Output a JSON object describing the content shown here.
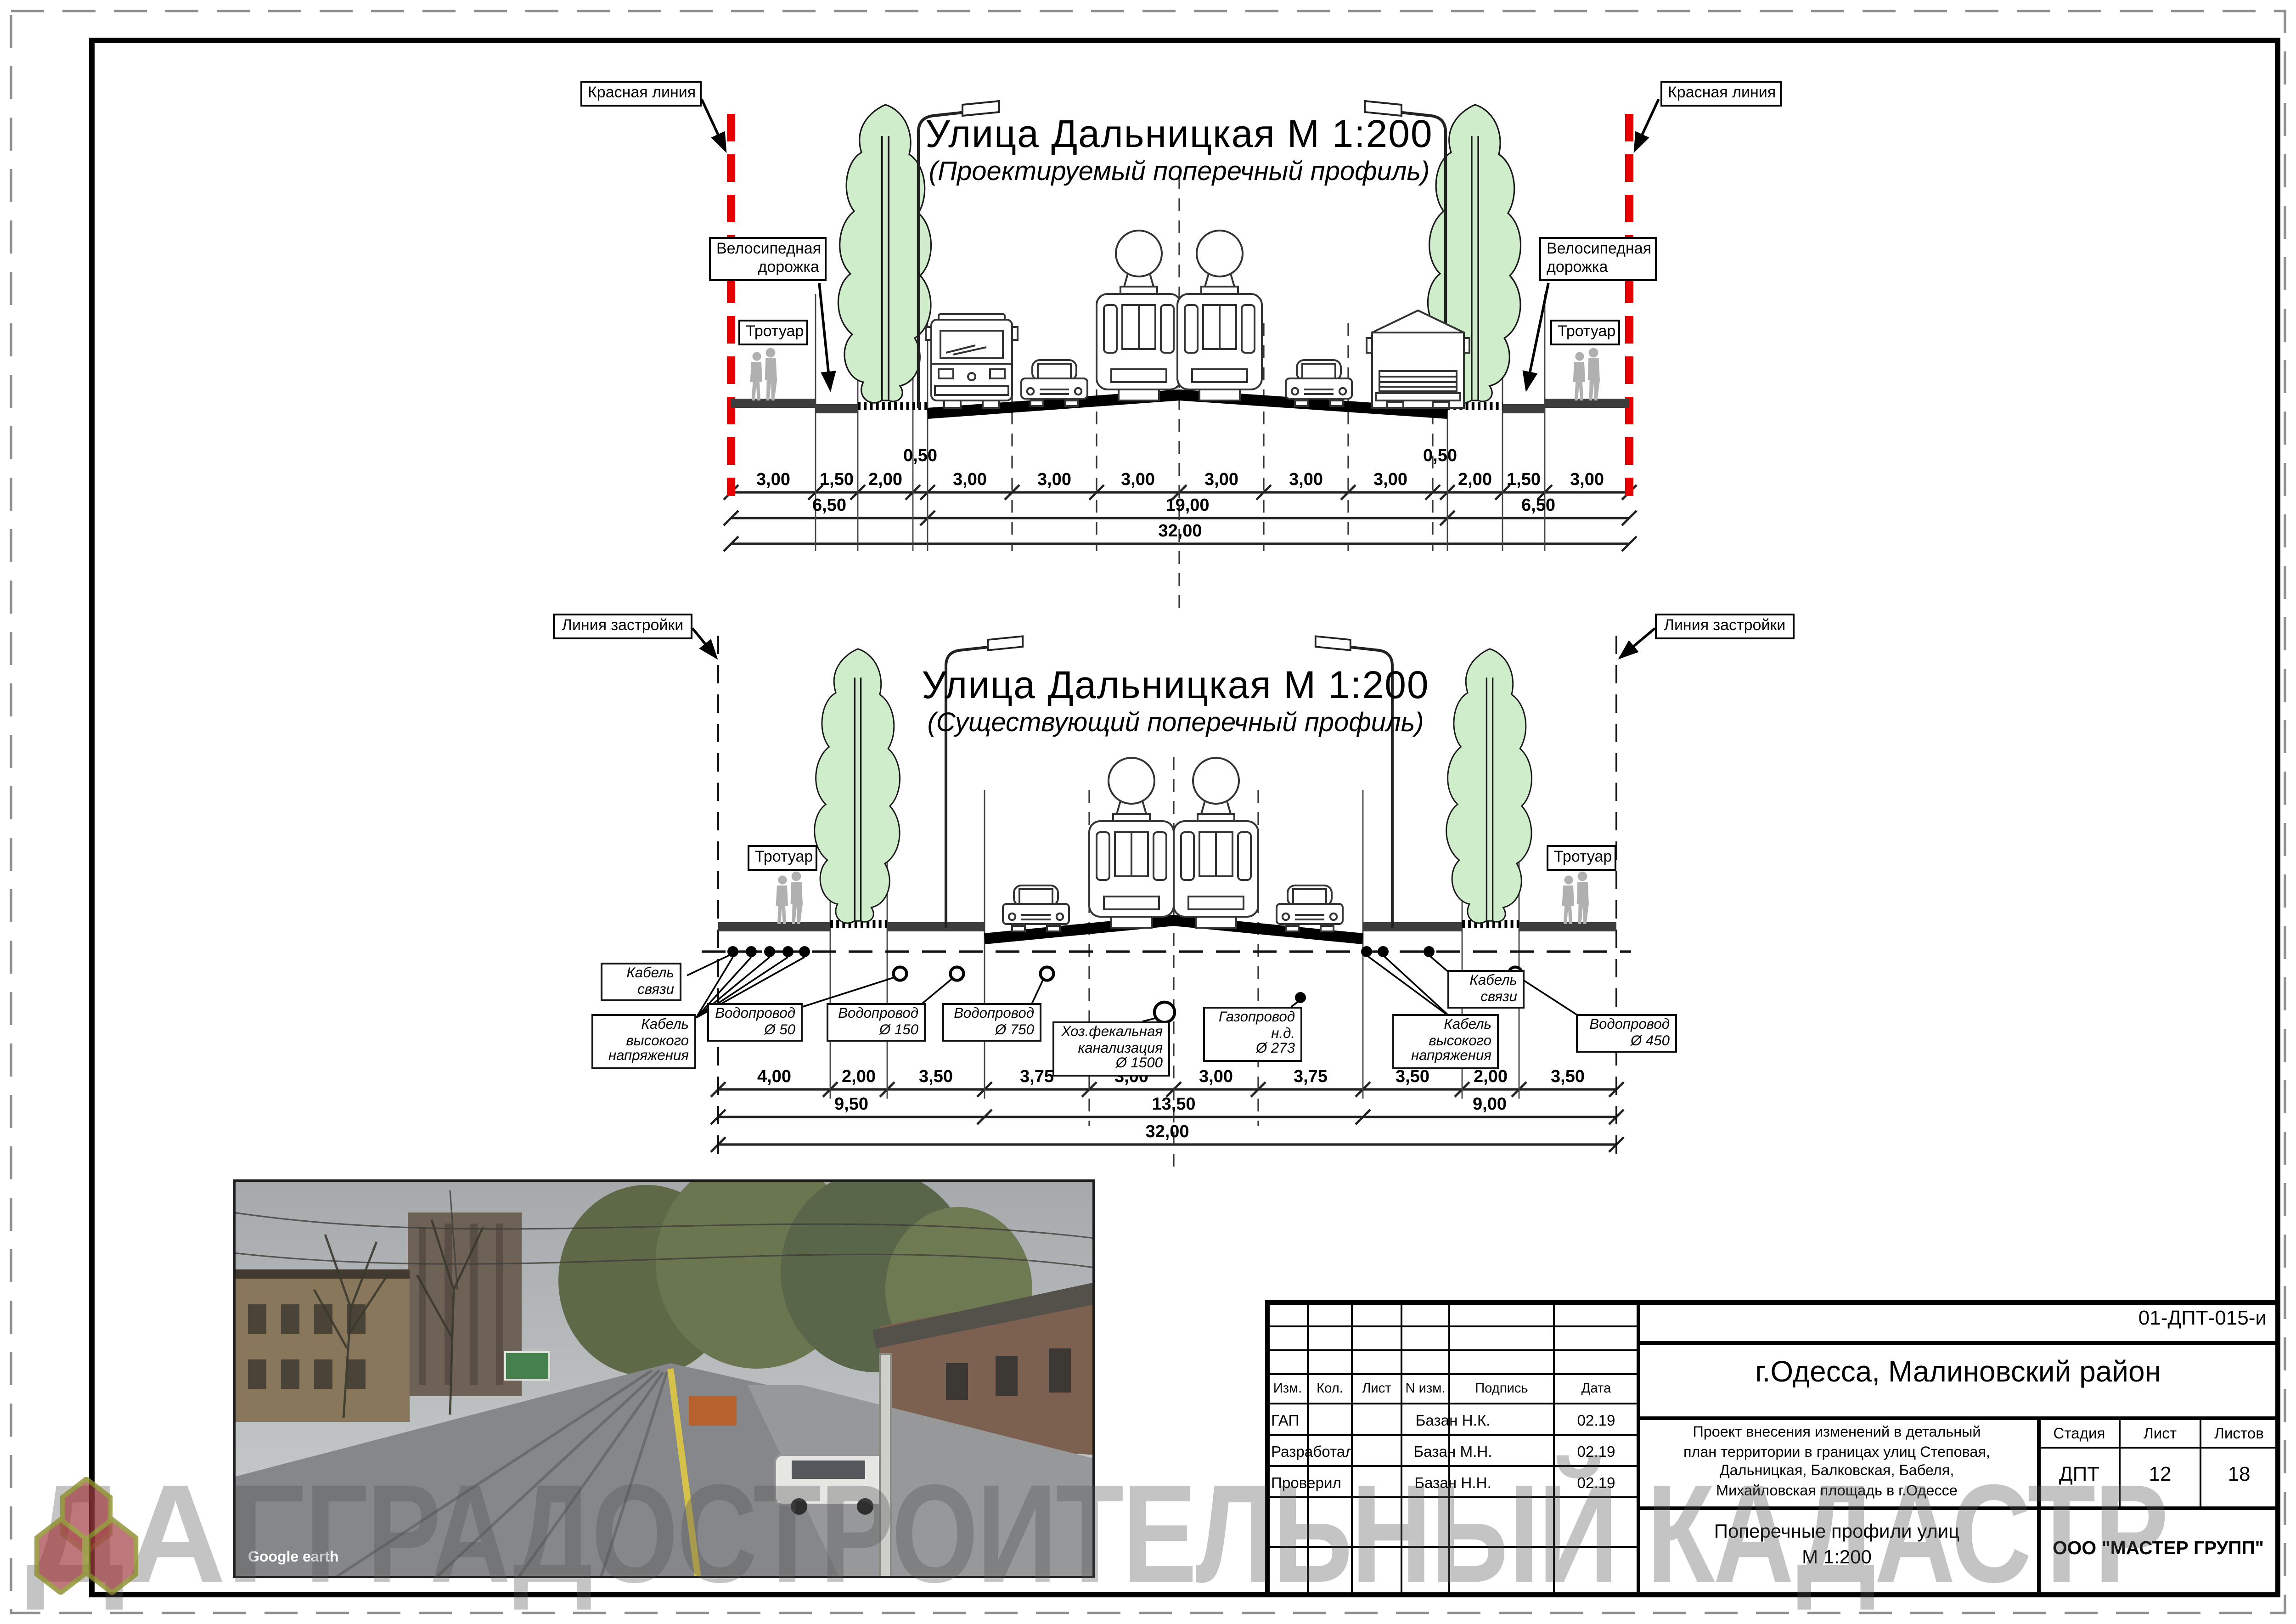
{
  "colors": {
    "red_line": "#e60000",
    "tree_green": "#cfeccb",
    "sidewalk_gray": "#3d3d3d",
    "watermark_gray": "#bdbdbd",
    "logo_red": "#9e3438",
    "logo_olive": "#8f8f2e"
  },
  "top_profile": {
    "title": "Улица Дальницкая М 1:200",
    "subtitle": "(Проектируемый поперечный профиль)",
    "red_line_label": "Красная линия",
    "bike_label_line1": "Велосипедная",
    "bike_label_line2": "дорожка",
    "sidewalk_label": "Тротуар",
    "dims_row1": [
      "3,00",
      "1,50",
      "2,00",
      "0,50",
      "3,00",
      "3,00",
      "3,00",
      "3,00",
      "3,00",
      "3,00",
      "0,50",
      "2,00",
      "1,50",
      "3,00"
    ],
    "dims_row2": [
      "6,50",
      "19,00",
      "6,50"
    ],
    "dims_row3": [
      "32,00"
    ]
  },
  "bottom_profile": {
    "title": "Улица Дальницкая М 1:200",
    "subtitle": "(Существующий поперечный профиль)",
    "building_line_label": "Линия застройки",
    "sidewalk_label": "Тротуар",
    "utilities": [
      {
        "id": "cable-comm-left",
        "lines": [
          "Кабель",
          "связи"
        ]
      },
      {
        "id": "cable-hv-left",
        "lines": [
          "Кабель",
          "высокого",
          "напряжения"
        ]
      },
      {
        "id": "water-50",
        "lines": [
          "Водопровод",
          "Ø 50"
        ]
      },
      {
        "id": "water-150",
        "lines": [
          "Водопровод",
          "Ø 150"
        ]
      },
      {
        "id": "water-750",
        "lines": [
          "Водопровод",
          "Ø 750"
        ]
      },
      {
        "id": "sewer-1500",
        "lines": [
          "Хоз.фекальная",
          "канализация",
          "Ø 1500"
        ]
      },
      {
        "id": "gas-273",
        "lines": [
          "Газопровод",
          "н.д.",
          "Ø 273"
        ]
      },
      {
        "id": "cable-hv-right",
        "lines": [
          "Кабель",
          "высокого",
          "напряжения"
        ]
      },
      {
        "id": "cable-comm-right",
        "lines": [
          "Кабель",
          "связи"
        ]
      },
      {
        "id": "water-450",
        "lines": [
          "Водопровод",
          "Ø 450"
        ]
      }
    ],
    "dims_row1": [
      "4,00",
      "2,00",
      "3,50",
      "3,75",
      "3,00",
      "3,00",
      "3,75",
      "3,50",
      "2,00",
      "3,50"
    ],
    "dims_row2": [
      "9,50",
      "13,50",
      "9,00"
    ],
    "dims_row3": [
      "32,00"
    ]
  },
  "photo": {
    "credit": "Google earth"
  },
  "watermark": {
    "prefix": "ДАГ",
    "suffix": "ГРАДОСТРОИТЕЛЬНЫЙ КАДАСТР"
  },
  "title_block": {
    "code": "01-ДПТ-015-и",
    "region": "г.Одесса, Малиновский район",
    "columns": [
      "Изм.",
      "Кол.",
      "Лист",
      "N изм.",
      "Подпись",
      "Дата"
    ],
    "signature_rows": [
      {
        "role": "ГАП",
        "name": "Базан Н.К.",
        "date": "02.19"
      },
      {
        "role": "Разработал",
        "name": "Базан М.Н.",
        "date": "02.19"
      },
      {
        "role": "Проверил",
        "name": "Базан Н.Н.",
        "date": "02.19"
      }
    ],
    "project_lines": [
      "Проект внесения изменений в детальный",
      "план территории в границах улиц Степовая,",
      "Дальницкая, Балковская, Бабеля,",
      "Михайловская площадь в г.Одессе"
    ],
    "stage_label": "Стадия",
    "sheet_label": "Лист",
    "sheets_label": "Листов",
    "stage": "ДПТ",
    "sheet": "12",
    "sheets": "18",
    "sheet_title_lines": [
      "Поперечные профили улиц",
      "М 1:200"
    ],
    "company": "ООО \"МАСТЕР ГРУПП\""
  }
}
